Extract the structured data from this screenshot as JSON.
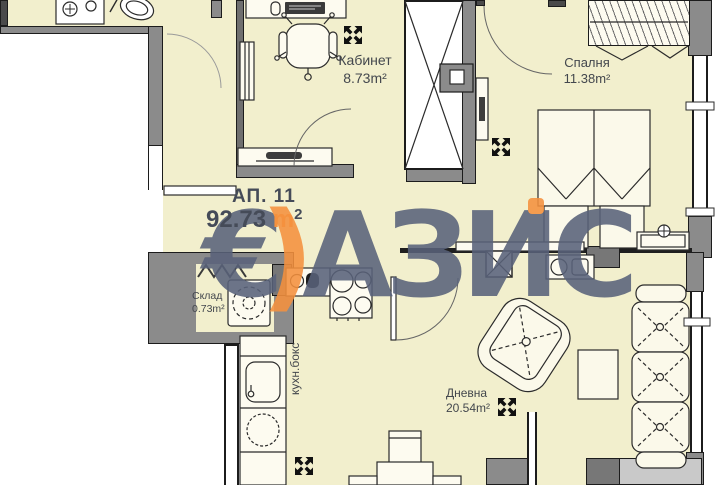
{
  "colors": {
    "floor": "#f2efcd",
    "wall": "#8b8b8b",
    "wall-light": "#c9c9c9",
    "line": "#1c1c1c",
    "label": "#43474d",
    "wm": "#59627a",
    "accent": "#f5913e"
  },
  "watermark": {
    "euro": "€",
    "paren": ")",
    "part1": "АЗ",
    "part2": "И",
    "part3": "С"
  },
  "apartment": {
    "label": "АП. 11",
    "area_number": "92.73",
    "area_unit": "m",
    "area_exp": "2"
  },
  "rooms": {
    "office": {
      "name": "Кабинет",
      "area": "8.73m²"
    },
    "bedroom": {
      "name": "Спалня",
      "area": "11.38m²"
    },
    "storage": {
      "name": "Склад",
      "area": "0.73m²"
    },
    "living": {
      "name": "Дневна",
      "area": "20.54m²"
    },
    "kitchen": {
      "name": "кухн.бокс"
    }
  }
}
